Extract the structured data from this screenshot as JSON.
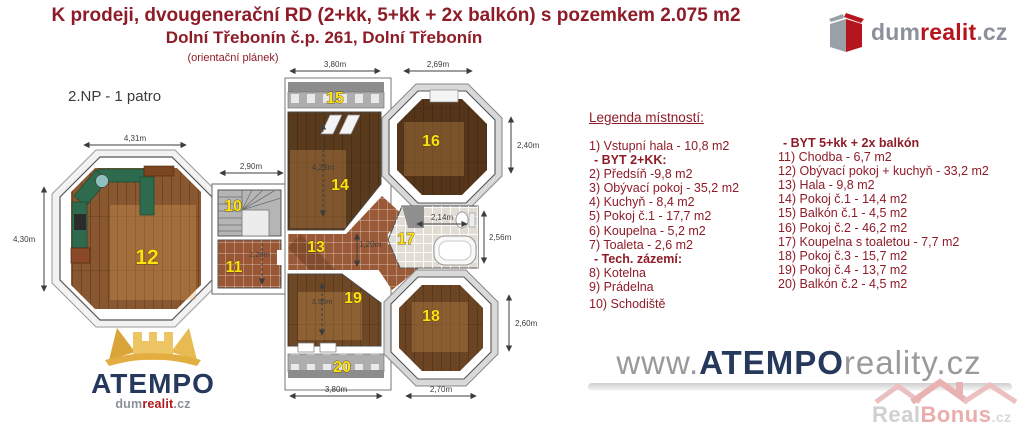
{
  "header": {
    "title_line1": "K prodeji, dvougenerační RD (2+kk, 5+kk + 2x balkón) s pozemkem 2.075 m2",
    "title_line2": "Dolní Třebonín č.p. 261, Dolní Třebonín",
    "title_line3": "(orientační plánek)"
  },
  "brand_top": {
    "dum": "dum",
    "realit": "realit",
    "cz": ".cz"
  },
  "plan": {
    "floor_label": "2.NP - 1 patro",
    "rooms": {
      "r10": "10",
      "r11": "11",
      "r12": "12",
      "r13": "13",
      "r14": "14",
      "r15": "15",
      "r16": "16",
      "r17": "17",
      "r18": "18",
      "r19": "19",
      "r20": "20"
    },
    "dims": {
      "d431": "4,31m",
      "d430": "4,30m",
      "d290": "2,90m",
      "d380top": "3,80m",
      "d269": "2,69m",
      "d240": "2,40m",
      "d428": "4,28m",
      "d120": "1,20m",
      "d214": "2,14m",
      "d256": "2,56m",
      "d220": "2,20m",
      "d395": "3,95m",
      "d260": "2,60m",
      "d380bottom": "3,80m",
      "d270": "2,70m"
    }
  },
  "legend": {
    "title": "Legenda místností:",
    "left": [
      "1) Vstupní hala - 10,8 m2",
      "- BYT 2+KK:",
      "2) Předsíň -9,8 m2",
      "3) Obývací pokoj - 35,2 m2",
      "4) Kuchyň - 8,4 m2",
      "5) Pokoj č.1 - 17,7 m2",
      "6) Koupelna - 5,2 m2",
      "7) Toaleta - 2,6 m2",
      "- Tech. zázemí:",
      "8) Kotelna",
      "9) Prádelna",
      "10) Schodiště"
    ],
    "right": [
      "- BYT 5+kk + 2x balkón",
      "11) Chodba - 6,7 m2",
      "12) Obývací pokoj + kuchyň - 33,2 m2",
      "13) Hala - 9,8 m2",
      "14) Pokoj č.1 - 14,4 m2",
      "15) Balkón č.1 - 4,5 m2",
      "16) Pokoj č.2 - 46,2 m2",
      "17) Koupelna s toaletou - 7,7 m2",
      "18) Pokoj č.3 - 15,7 m2",
      "19) Pokoj č.4 - 13,7 m2",
      "20) Balkón č.2 - 4,5 m2"
    ]
  },
  "watermark": {
    "www": "www.",
    "brand": "ATEMPO",
    "rest": "reality.cz"
  },
  "logo_atempo": {
    "name": "ATEMPO",
    "dum": "dum",
    "realit": "realit",
    "cz": ".cz"
  },
  "realbonus": {
    "real": "Real",
    "bonus": "Bonus",
    "cz": ".cz"
  }
}
